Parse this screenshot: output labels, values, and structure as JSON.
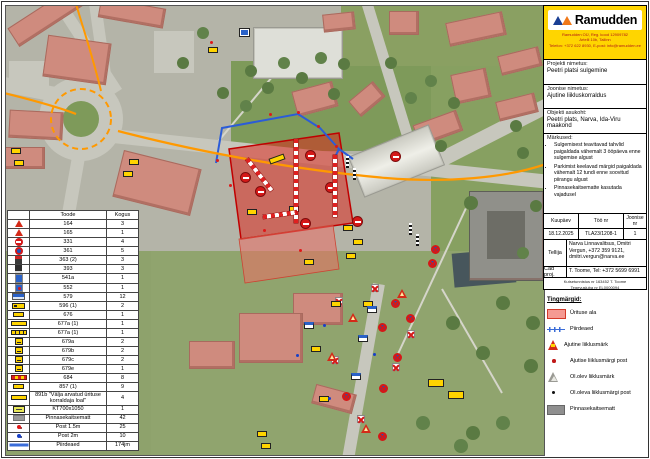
{
  "logo": {
    "brand": "Ramudden",
    "line1": "Ramudden OÜ, Reg. kood 12909782",
    "line2": "Artelli 10b, Tallinn",
    "line3": "Telefon: +372 622 8930, E-post: info@ramudden.ee"
  },
  "panel": {
    "project_label": "Projekti nimetus:",
    "project_value": "Peetri platsi sulgemine",
    "drawing_label": "Joonise nimetus:",
    "drawing_value": "Ajutine liikluskorraldus",
    "location_label": "Objekti asukoht:",
    "location_value": "Peetri plats, Narva, Ida-Viru maakond",
    "notes_label": "Märkused:",
    "notes": [
      "Sulgemisest teavitavad tahvlid paigaldada vähemalt 3 ööpäeva enne sulgemise algust",
      "Parkimist keelavad märgid paigaldada vähemalt 12 tundi enne soovitud piirangu algust",
      "Pinnasekaitsematte kasutada vajadusel"
    ],
    "date_label": "Kuupäev",
    "date_value": "18.12.2025",
    "work_label": "Töö nr",
    "work_value": "TLA23/1208-1",
    "sheet_label": "Joonise nr",
    "sheet_value": "1",
    "client_label": "Tellija",
    "client_value": "Narva Linnavalitsus, Dmitri Vergun, +372 359 9121, dmitri.vergun@narva.ee",
    "cad_label": "Cad proj.",
    "cad_value": "T. Toome, Tel: +372 5699 6991",
    "fineprint1": "Kutsetunnistus nr 163452 T. Toome",
    "fineprint2": "Tegevusluba nr EL0000094"
  },
  "symbols": {
    "title": "Tingmärgid:",
    "items": [
      {
        "icon": "area",
        "label": "Ürituse ala"
      },
      {
        "icon": "fence",
        "label": "Piirdeaed"
      },
      {
        "icon": "tri-red",
        "label": "Ajutine liiklusmärk"
      },
      {
        "icon": "dot-red",
        "label": "Ajutise liiklusmärgi post"
      },
      {
        "icon": "tri-gray",
        "label": "Ol.olev liiklusmärk"
      },
      {
        "icon": "dot-black",
        "label": "Ol.oleva liiklusmärgi post"
      },
      {
        "icon": "mat",
        "label": "Pinnasekaitsematt"
      }
    ]
  },
  "products": {
    "headers": {
      "product": "Toode",
      "qty": "Kogus"
    },
    "rows": [
      {
        "icon": "tri",
        "name": "164",
        "qty": "3"
      },
      {
        "icon": "tri",
        "name": "165",
        "qty": "1"
      },
      {
        "icon": "circle-red",
        "name": "331",
        "qty": "4"
      },
      {
        "icon": "circle-ns",
        "name": "361",
        "qty": "5"
      },
      {
        "icon": "sq-dark-red",
        "name": "363 (2)",
        "qty": "3"
      },
      {
        "icon": "sq-dark",
        "name": "393",
        "qty": "3"
      },
      {
        "icon": "rect-blue",
        "name": "541a",
        "qty": "1"
      },
      {
        "icon": "sq-blue-red",
        "name": "552",
        "qty": "1"
      },
      {
        "icon": "rect-blue-wide",
        "name": "579",
        "qty": "12"
      },
      {
        "icon": "yp-arrow",
        "name": "596 (1)",
        "qty": "2"
      },
      {
        "icon": "yp-small",
        "name": "676",
        "qty": "1"
      },
      {
        "icon": "yp-long",
        "name": "677a (1)",
        "qty": "1"
      },
      {
        "icon": "yp-long2",
        "name": "677a (1)",
        "qty": "1"
      },
      {
        "icon": "yp-sq",
        "name": "679a",
        "qty": "2"
      },
      {
        "icon": "yp-sq",
        "name": "679b",
        "qty": "2"
      },
      {
        "icon": "yp-sq",
        "name": "679c",
        "qty": "2"
      },
      {
        "icon": "yp-sq",
        "name": "679e",
        "qty": "1"
      },
      {
        "icon": "stripe",
        "name": "684",
        "qty": "8"
      },
      {
        "icon": "yp-small",
        "name": "857 (1)",
        "qty": "9"
      },
      {
        "icon": "yp-long",
        "name": "891b \"Välja arvatud ürituse korraldaja loal\"",
        "qty": "4"
      },
      {
        "icon": "kt",
        "name": "KT700x1050",
        "qty": "1"
      },
      {
        "icon": "gray",
        "name": "Pinnasekaitsematt",
        "qty": "42"
      },
      {
        "icon": "post-red",
        "name": "Post 1.5m",
        "qty": "25"
      },
      {
        "icon": "post-blue",
        "name": "Post 2m",
        "qty": "10"
      },
      {
        "icon": "fence",
        "name": "Piirdeaed",
        "qty": "174jm"
      }
    ]
  },
  "colors": {
    "brand_yellow": "#ffd500",
    "event_area_red": "#e01e14",
    "fence_blue": "#3a6cd8",
    "route_orange": "#ff9900"
  },
  "markers": [
    {
      "t": "ns",
      "x": 385,
      "y": 293
    },
    {
      "t": "ns",
      "x": 372,
      "y": 317
    },
    {
      "t": "ns",
      "x": 400,
      "y": 308
    },
    {
      "t": "ns",
      "x": 387,
      "y": 347
    },
    {
      "t": "ns",
      "x": 373,
      "y": 378
    },
    {
      "t": "ns",
      "x": 336,
      "y": 386
    },
    {
      "t": "ns",
      "x": 372,
      "y": 426
    },
    {
      "t": "ns",
      "x": 425,
      "y": 239
    },
    {
      "t": "ns",
      "x": 422,
      "y": 253
    },
    {
      "t": "rc",
      "x": 300,
      "y": 145
    },
    {
      "t": "rc",
      "x": 235,
      "y": 167
    },
    {
      "t": "rc",
      "x": 250,
      "y": 181
    },
    {
      "t": "rc",
      "x": 320,
      "y": 177
    },
    {
      "t": "rc",
      "x": 295,
      "y": 213
    },
    {
      "t": "rc",
      "x": 347,
      "y": 211
    },
    {
      "t": "rc",
      "x": 385,
      "y": 146
    },
    {
      "t": "rx",
      "x": 365,
      "y": 278
    },
    {
      "t": "rx",
      "x": 329,
      "y": 291
    },
    {
      "t": "rx",
      "x": 401,
      "y": 324
    },
    {
      "t": "rx",
      "x": 386,
      "y": 357
    },
    {
      "t": "rx",
      "x": 351,
      "y": 409
    },
    {
      "t": "rx",
      "x": 325,
      "y": 350
    },
    {
      "t": "wt",
      "x": 391,
      "y": 283
    },
    {
      "t": "wt",
      "x": 342,
      "y": 307
    },
    {
      "t": "wt",
      "x": 355,
      "y": 418
    },
    {
      "t": "wt",
      "x": 321,
      "y": 346
    },
    {
      "t": "yp",
      "x": 202,
      "y": 41
    },
    {
      "t": "yp",
      "x": 123,
      "y": 153
    },
    {
      "t": "yp",
      "x": 117,
      "y": 165
    },
    {
      "t": "yp",
      "x": 5,
      "y": 142
    },
    {
      "t": "yp",
      "x": 8,
      "y": 154
    },
    {
      "t": "yp",
      "x": 263,
      "y": 150,
      "w": 16,
      "r": -20
    },
    {
      "t": "yp",
      "x": 283,
      "y": 200
    },
    {
      "t": "yp",
      "x": 241,
      "y": 203
    },
    {
      "t": "yp",
      "x": 337,
      "y": 219
    },
    {
      "t": "yp",
      "x": 347,
      "y": 233
    },
    {
      "t": "yp",
      "x": 340,
      "y": 247
    },
    {
      "t": "yp",
      "x": 325,
      "y": 295
    },
    {
      "t": "yp",
      "x": 357,
      "y": 295
    },
    {
      "t": "yp",
      "x": 305,
      "y": 340
    },
    {
      "t": "yp",
      "x": 313,
      "y": 390
    },
    {
      "t": "yp",
      "x": 251,
      "y": 425
    },
    {
      "t": "yp",
      "x": 255,
      "y": 437
    },
    {
      "t": "yp",
      "x": 298,
      "y": 253
    },
    {
      "t": "yp",
      "x": 422,
      "y": 373,
      "w": 16,
      "h": 8
    },
    {
      "t": "yp",
      "x": 442,
      "y": 385,
      "w": 16,
      "h": 8
    },
    {
      "t": "bw",
      "x": 352,
      "y": 329
    },
    {
      "t": "bw",
      "x": 345,
      "y": 367
    },
    {
      "t": "bw",
      "x": 298,
      "y": 316
    },
    {
      "t": "bw",
      "x": 361,
      "y": 300
    },
    {
      "t": "bs",
      "x": 234,
      "y": 23
    },
    {
      "t": "pole",
      "x": 340,
      "y": 150
    },
    {
      "t": "pole",
      "x": 347,
      "y": 162
    },
    {
      "t": "pole",
      "x": 403,
      "y": 217
    },
    {
      "t": "pole",
      "x": 410,
      "y": 228
    },
    {
      "t": "rd",
      "x": 210,
      "y": 153
    },
    {
      "t": "rd",
      "x": 263,
      "y": 107
    },
    {
      "t": "rd",
      "x": 291,
      "y": 105
    },
    {
      "t": "rd",
      "x": 311,
      "y": 119
    },
    {
      "t": "rd",
      "x": 329,
      "y": 139
    },
    {
      "t": "rd",
      "x": 223,
      "y": 178
    },
    {
      "t": "rd",
      "x": 257,
      "y": 223
    },
    {
      "t": "rd",
      "x": 204,
      "y": 35
    },
    {
      "t": "rd",
      "x": 293,
      "y": 243
    },
    {
      "t": "bd",
      "x": 317,
      "y": 318
    },
    {
      "t": "bd",
      "x": 322,
      "y": 391
    },
    {
      "t": "bd",
      "x": 290,
      "y": 348
    },
    {
      "t": "bd",
      "x": 367,
      "y": 347
    },
    {
      "t": "bar",
      "x": 241,
      "y": 151,
      "w": 40,
      "r": 52
    },
    {
      "t": "bar",
      "x": 290,
      "y": 131,
      "w": 84,
      "r": 90
    },
    {
      "t": "bar",
      "x": 257,
      "y": 209,
      "w": 34,
      "r": -8
    },
    {
      "t": "bar",
      "x": 329,
      "y": 147,
      "w": 62,
      "r": 90
    }
  ]
}
